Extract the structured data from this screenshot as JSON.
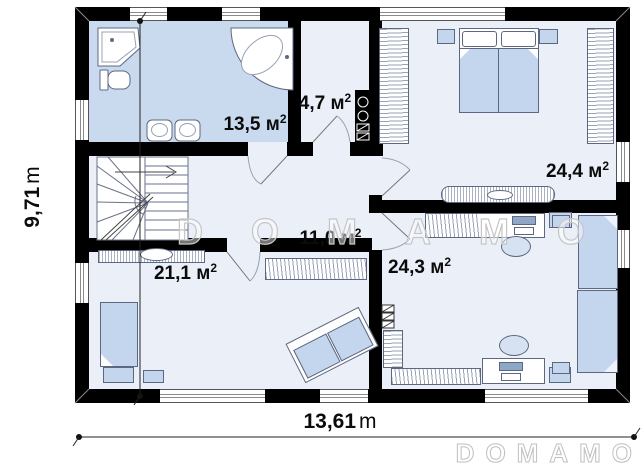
{
  "watermark": {
    "center": "DOMAMO",
    "corner": "DOMAMO"
  },
  "dimensions": {
    "height": {
      "value": "9,71",
      "unit": "m"
    },
    "width": {
      "value": "13,61",
      "unit": "m"
    }
  },
  "rooms": [
    {
      "id": "bathroom",
      "area": "13,5",
      "unit": "м",
      "sup": "2"
    },
    {
      "id": "boiler-room",
      "area": "4,7",
      "unit": "м",
      "sup": "2"
    },
    {
      "id": "bedroom",
      "area": "24,4",
      "unit": "м",
      "sup": "2"
    },
    {
      "id": "hallway",
      "area": "11,0",
      "unit": "м",
      "sup": "2"
    },
    {
      "id": "room-lower-left",
      "area": "21,1",
      "unit": "м",
      "sup": "2"
    },
    {
      "id": "room-lower-right",
      "area": "24,3",
      "unit": "м",
      "sup": "2"
    }
  ],
  "colors": {
    "wall": "#000000",
    "bathroom_floor": "#c9daee",
    "floor": "#ebf0f8",
    "furniture_blue": "#c3d6ee",
    "watermark_outline": "#c6c6c6"
  }
}
